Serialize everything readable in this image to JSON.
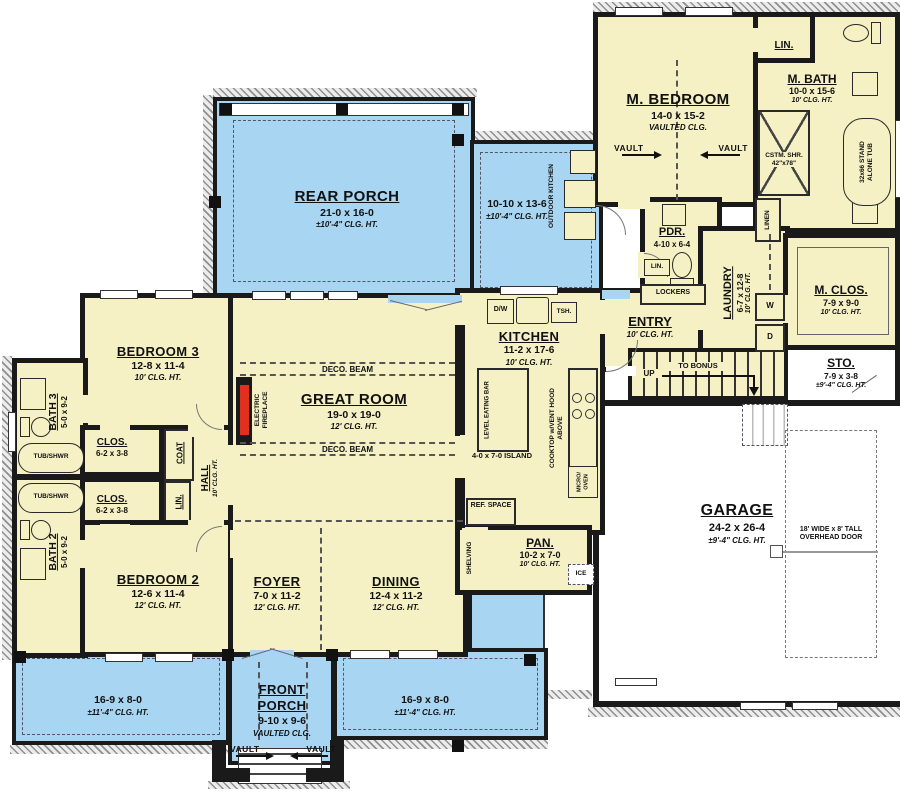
{
  "title": "First-floor house plan",
  "colors": {
    "room_fill": "#f5f1c4",
    "porch_fill": "#a8d5f2",
    "wall": "#1a1a1a",
    "fireplace_red": "#e0301e",
    "garage_fill": "#ffffff"
  },
  "rooms": {
    "rear_porch": {
      "name": "REAR PORCH",
      "dims": "21-0 x 16-0",
      "clg": "±10'-4\" CLG. HT."
    },
    "side_porch": {
      "dims": "10-10 x 13-6",
      "clg": "±10'-4\" CLG. HT."
    },
    "outdoor_kitchen": {
      "name": "OUTDOOR KITCHEN"
    },
    "m_bedroom": {
      "name": "M. BEDROOM",
      "dims": "14-0 x 15-2",
      "clg": "VAULTED CLG."
    },
    "m_bath": {
      "name": "M. BATH",
      "dims": "10-0 x 15-6",
      "clg": "10' CLG. HT."
    },
    "lin_top": {
      "name": "LIN."
    },
    "pdr": {
      "name": "PDR.",
      "dims": "4-10 x 6-4"
    },
    "lin_small": {
      "name": "LIN."
    },
    "entry": {
      "name": "ENTRY",
      "clg": "10' CLG. HT."
    },
    "laundry": {
      "name": "LAUNDRY",
      "dims": "6-7 x 12-8",
      "clg": "10' CLG. HT."
    },
    "m_clos": {
      "name": "M. CLOS.",
      "dims": "7-9 x 9-0",
      "clg": "10' CLG. HT."
    },
    "sto": {
      "name": "STO.",
      "dims": "7-9 x 3-8",
      "clg": "±9'-4\" CLG. HT."
    },
    "garage": {
      "name": "GARAGE",
      "dims": "24-2 x 26-4",
      "clg": "±9'-4\" CLG. HT."
    },
    "kitchen": {
      "name": "KITCHEN",
      "dims": "11-2 x 17-6",
      "clg": "10' CLG. HT."
    },
    "great_room": {
      "name": "GREAT ROOM",
      "dims": "19-0 x 19-0",
      "clg": "12' CLG. HT."
    },
    "bedroom3": {
      "name": "BEDROOM 3",
      "dims": "12-8 x 11-4",
      "clg": "10' CLG. HT."
    },
    "bath3": {
      "name": "BATH 3",
      "dims": "5-0 x 9-2"
    },
    "bath2": {
      "name": "BATH 2",
      "dims": "5-0 x 9-2"
    },
    "clos1": {
      "name": "CLOS.",
      "dims": "6-2 x 3-8"
    },
    "clos2": {
      "name": "CLOS.",
      "dims": "6-2 x 3-8"
    },
    "coat": {
      "name": "COAT"
    },
    "lin_hall": {
      "name": "LIN."
    },
    "hall": {
      "name": "HALL",
      "clg": "10' CLG. HT."
    },
    "bedroom2": {
      "name": "BEDROOM 2",
      "dims": "12-6 x 11-4",
      "clg": "12' CLG. HT."
    },
    "foyer": {
      "name": "FOYER",
      "dims": "7-0 x 11-2",
      "clg": "12' CLG. HT."
    },
    "dining": {
      "name": "DINING",
      "dims": "12-4 x 11-2",
      "clg": "12' CLG. HT."
    },
    "pan": {
      "name": "PAN.",
      "dims": "10-2 x 7-0",
      "clg": "10' CLG. HT."
    },
    "front_porch": {
      "name": "FRONT PORCH",
      "dims": "9-10 x 9-6",
      "clg": "VAULTED CLG."
    },
    "wing_left": {
      "dims": "16-9 x 8-0",
      "clg": "±11'-4\" CLG. HT."
    },
    "wing_right": {
      "dims": "16-9 x 8-0",
      "clg": "±11'-4\" CLG. HT."
    }
  },
  "fixtures": {
    "dw": "D/W",
    "tsh": "TSH.",
    "ref_space": "REF. SPACE",
    "ice": "ICE",
    "shelving": "SHELVING",
    "eating_bar": "LEVEL EATING BAR",
    "island": "4-0 x 7-0 ISLAND",
    "cooktop": "COOKTOP w/VENT HOOD ABOVE",
    "micro": "MICRO/ OVEN",
    "fireplace": "ELECTRIC FIREPLACE",
    "tub_shwr": "TUB/SHWR",
    "washer": "W",
    "dryer": "D",
    "lockers": "LOCKERS",
    "linen": "LINEN",
    "cstm_shr": "CSTM. SHR. 42\"x78\"",
    "stand_tub": "32x66 STAND ALONE TUB",
    "overhead_door": "18' WIDE x 8' TALL OVERHEAD DOOR"
  },
  "stairs": {
    "up": "UP",
    "to_bonus": "TO BONUS"
  },
  "annotations": {
    "vault": "VAULT",
    "deco_beam": "DECO. BEAM"
  }
}
